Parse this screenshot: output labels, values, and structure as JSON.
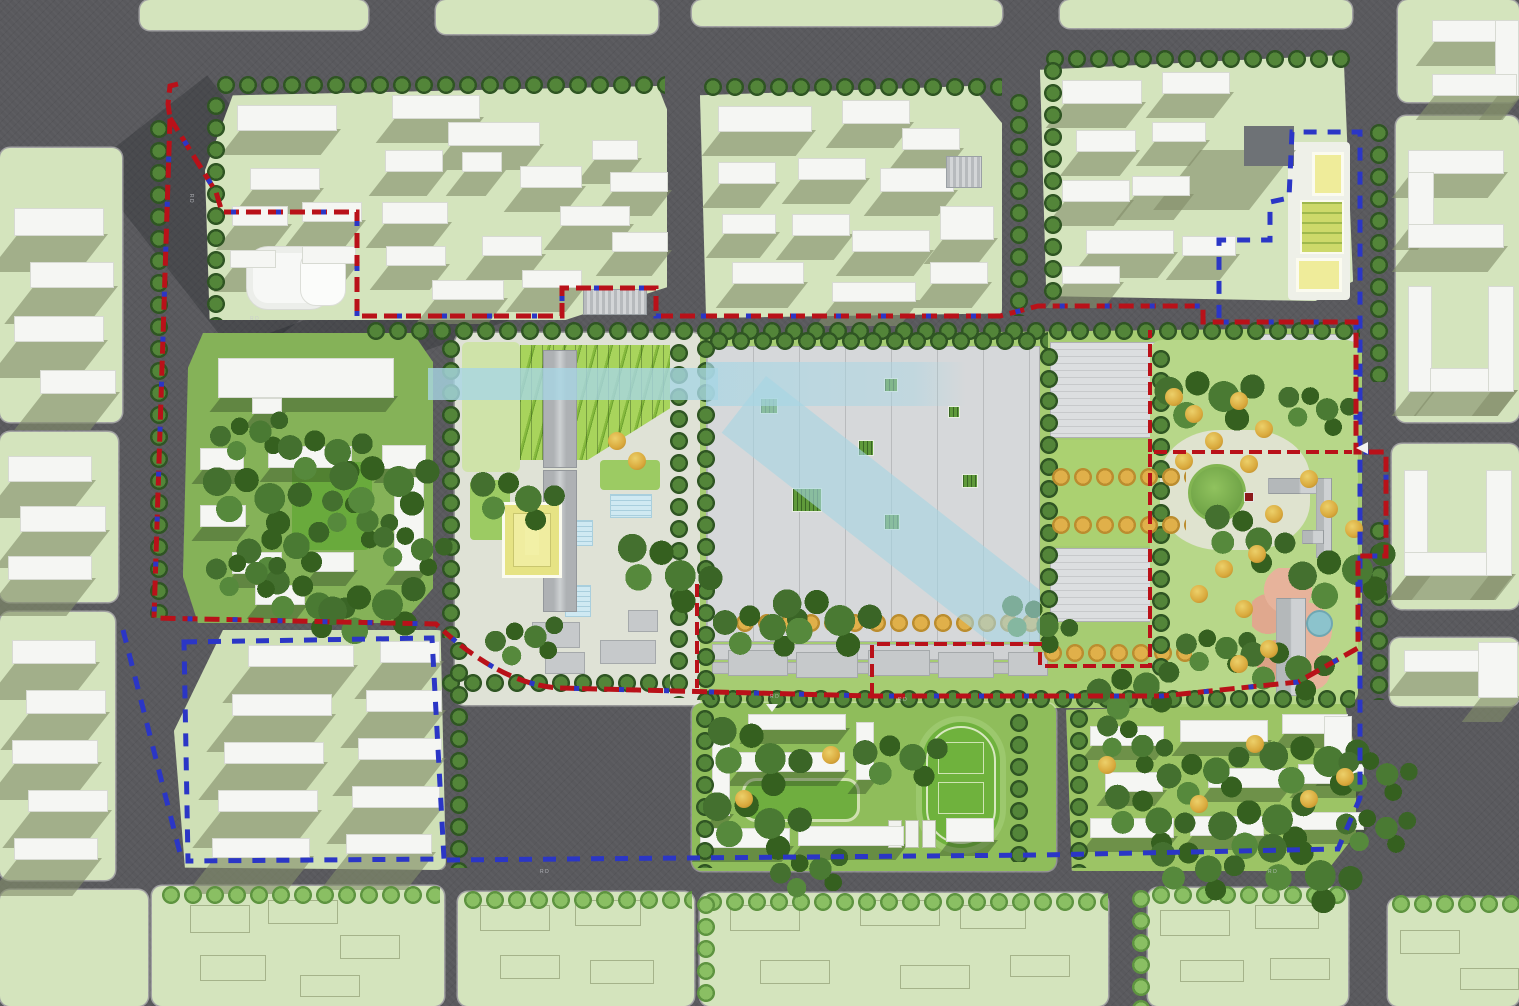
{
  "map": {
    "type": "urban masterplan site plan (aerial render)",
    "boundaries": {
      "red": {
        "name": "site boundary",
        "color": "#b91119",
        "style": "dashed"
      },
      "blue": {
        "name": "planning scope boundary",
        "color": "#2b36c6",
        "style": "dashed"
      }
    },
    "road_labels": [
      {
        "text": "RD"
      },
      {
        "text": "RD"
      },
      {
        "text": "RD"
      },
      {
        "text": "RD"
      },
      {
        "text": "RD"
      },
      {
        "text": "RD"
      }
    ],
    "palette": {
      "road": "#59595d",
      "parcel_green": "#d4e4bd",
      "building_white": "#f5f6f3",
      "shadow_olive": "#828e6a",
      "campus_green": "#85b258",
      "factory_roof": "#d6d8da",
      "water_band_cyan": "#a8d6e4",
      "street_tree_green": "#44702f",
      "orange_tree": "#d9a93c",
      "track_green": "#6fb23d",
      "pond_teal": "#8cc3cc",
      "plaza_pink": "#e7b39b",
      "highlight_yellow": "#efec9a"
    }
  }
}
